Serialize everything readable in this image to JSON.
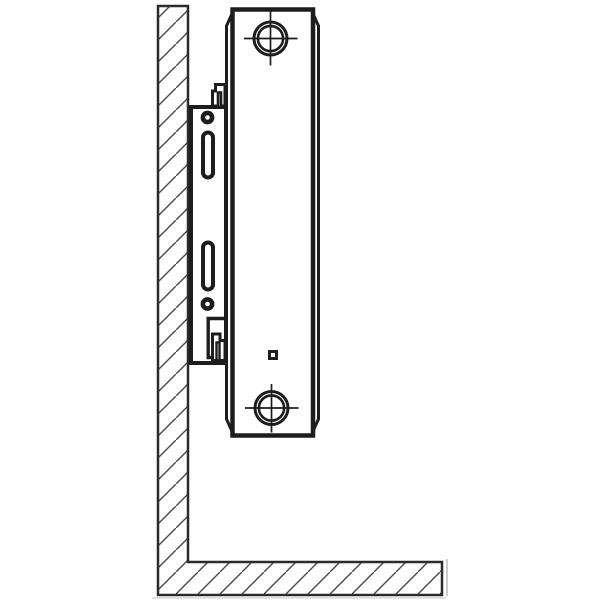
{
  "meta": {
    "title": "radiator-wall-mounting-side-view-diagram",
    "diagram_type": "technical-line-drawing",
    "has_text": false
  },
  "palette": {
    "background": "#ffffff",
    "outline_dark": "#1d1d1d",
    "outline_medium": "#2b2b2b",
    "hatch_line": "#4a4a4a",
    "artifact_gray": "#cccccc"
  },
  "components": {
    "wall": "hatched-wall-section",
    "floor": "hatched-floor-section",
    "radiator": "panel-radiator-side-profile",
    "top_port": "top-connection-port-crosshair",
    "bottom_port": "bottom-connection-port-crosshair",
    "vent_marker": "small-square-vent-marker",
    "bracket": "wall-mounting-bracket-plate",
    "screw_hole_top": "bracket-screw-hole-top",
    "screw_hole_bottom": "bracket-screw-hole-bottom",
    "slot_top": "bracket-adjustment-slot-top",
    "slot_bottom": "bracket-adjustment-slot-bottom",
    "top_hook": "bracket-top-retaining-hook",
    "bottom_notch": "bracket-bottom-support-notch",
    "bottom_clip": "radiator-bottom-clip"
  }
}
